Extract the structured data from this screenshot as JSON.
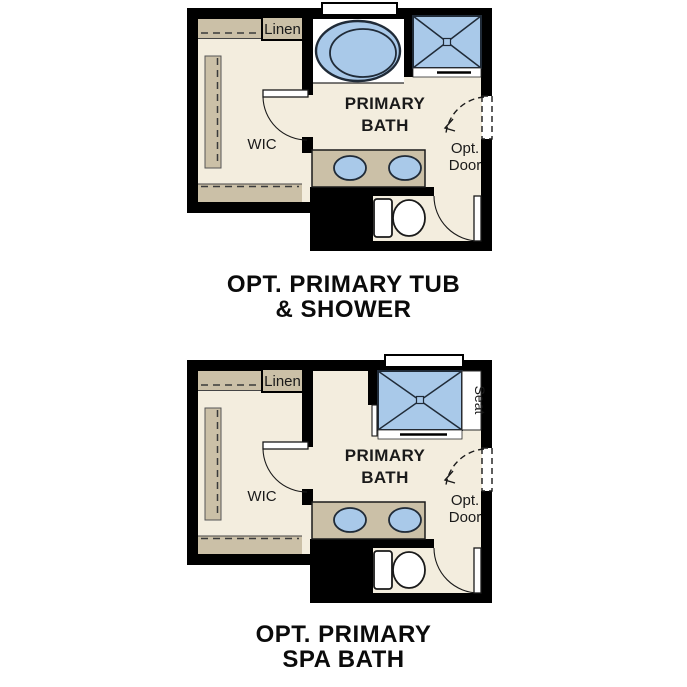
{
  "page": {
    "background": "#ffffff"
  },
  "colors": {
    "wall": "#000000",
    "floor": "#f3edde",
    "cabinet_tan": "#cbc0a7",
    "fixture_blue": "#a9c9e9",
    "fixture_outline": "#202b38",
    "text": "#1a1a1a"
  },
  "plans": [
    {
      "caption": {
        "line1": "OPT. PRIMARY TUB",
        "line2": "& SHOWER"
      },
      "labels": {
        "linen": "Linen",
        "wic": "WIC",
        "room_line1": "PRIMARY",
        "room_line2": "BATH",
        "opt_door_line1": "Opt.",
        "opt_door_line2": "Door"
      }
    },
    {
      "caption": {
        "line1": "OPT. PRIMARY",
        "line2": "SPA BATH"
      },
      "labels": {
        "linen": "Linen",
        "wic": "WIC",
        "room_line1": "PRIMARY",
        "room_line2": "BATH",
        "opt_door_line1": "Opt.",
        "opt_door_line2": "Door",
        "seat": "Seat"
      }
    }
  ]
}
